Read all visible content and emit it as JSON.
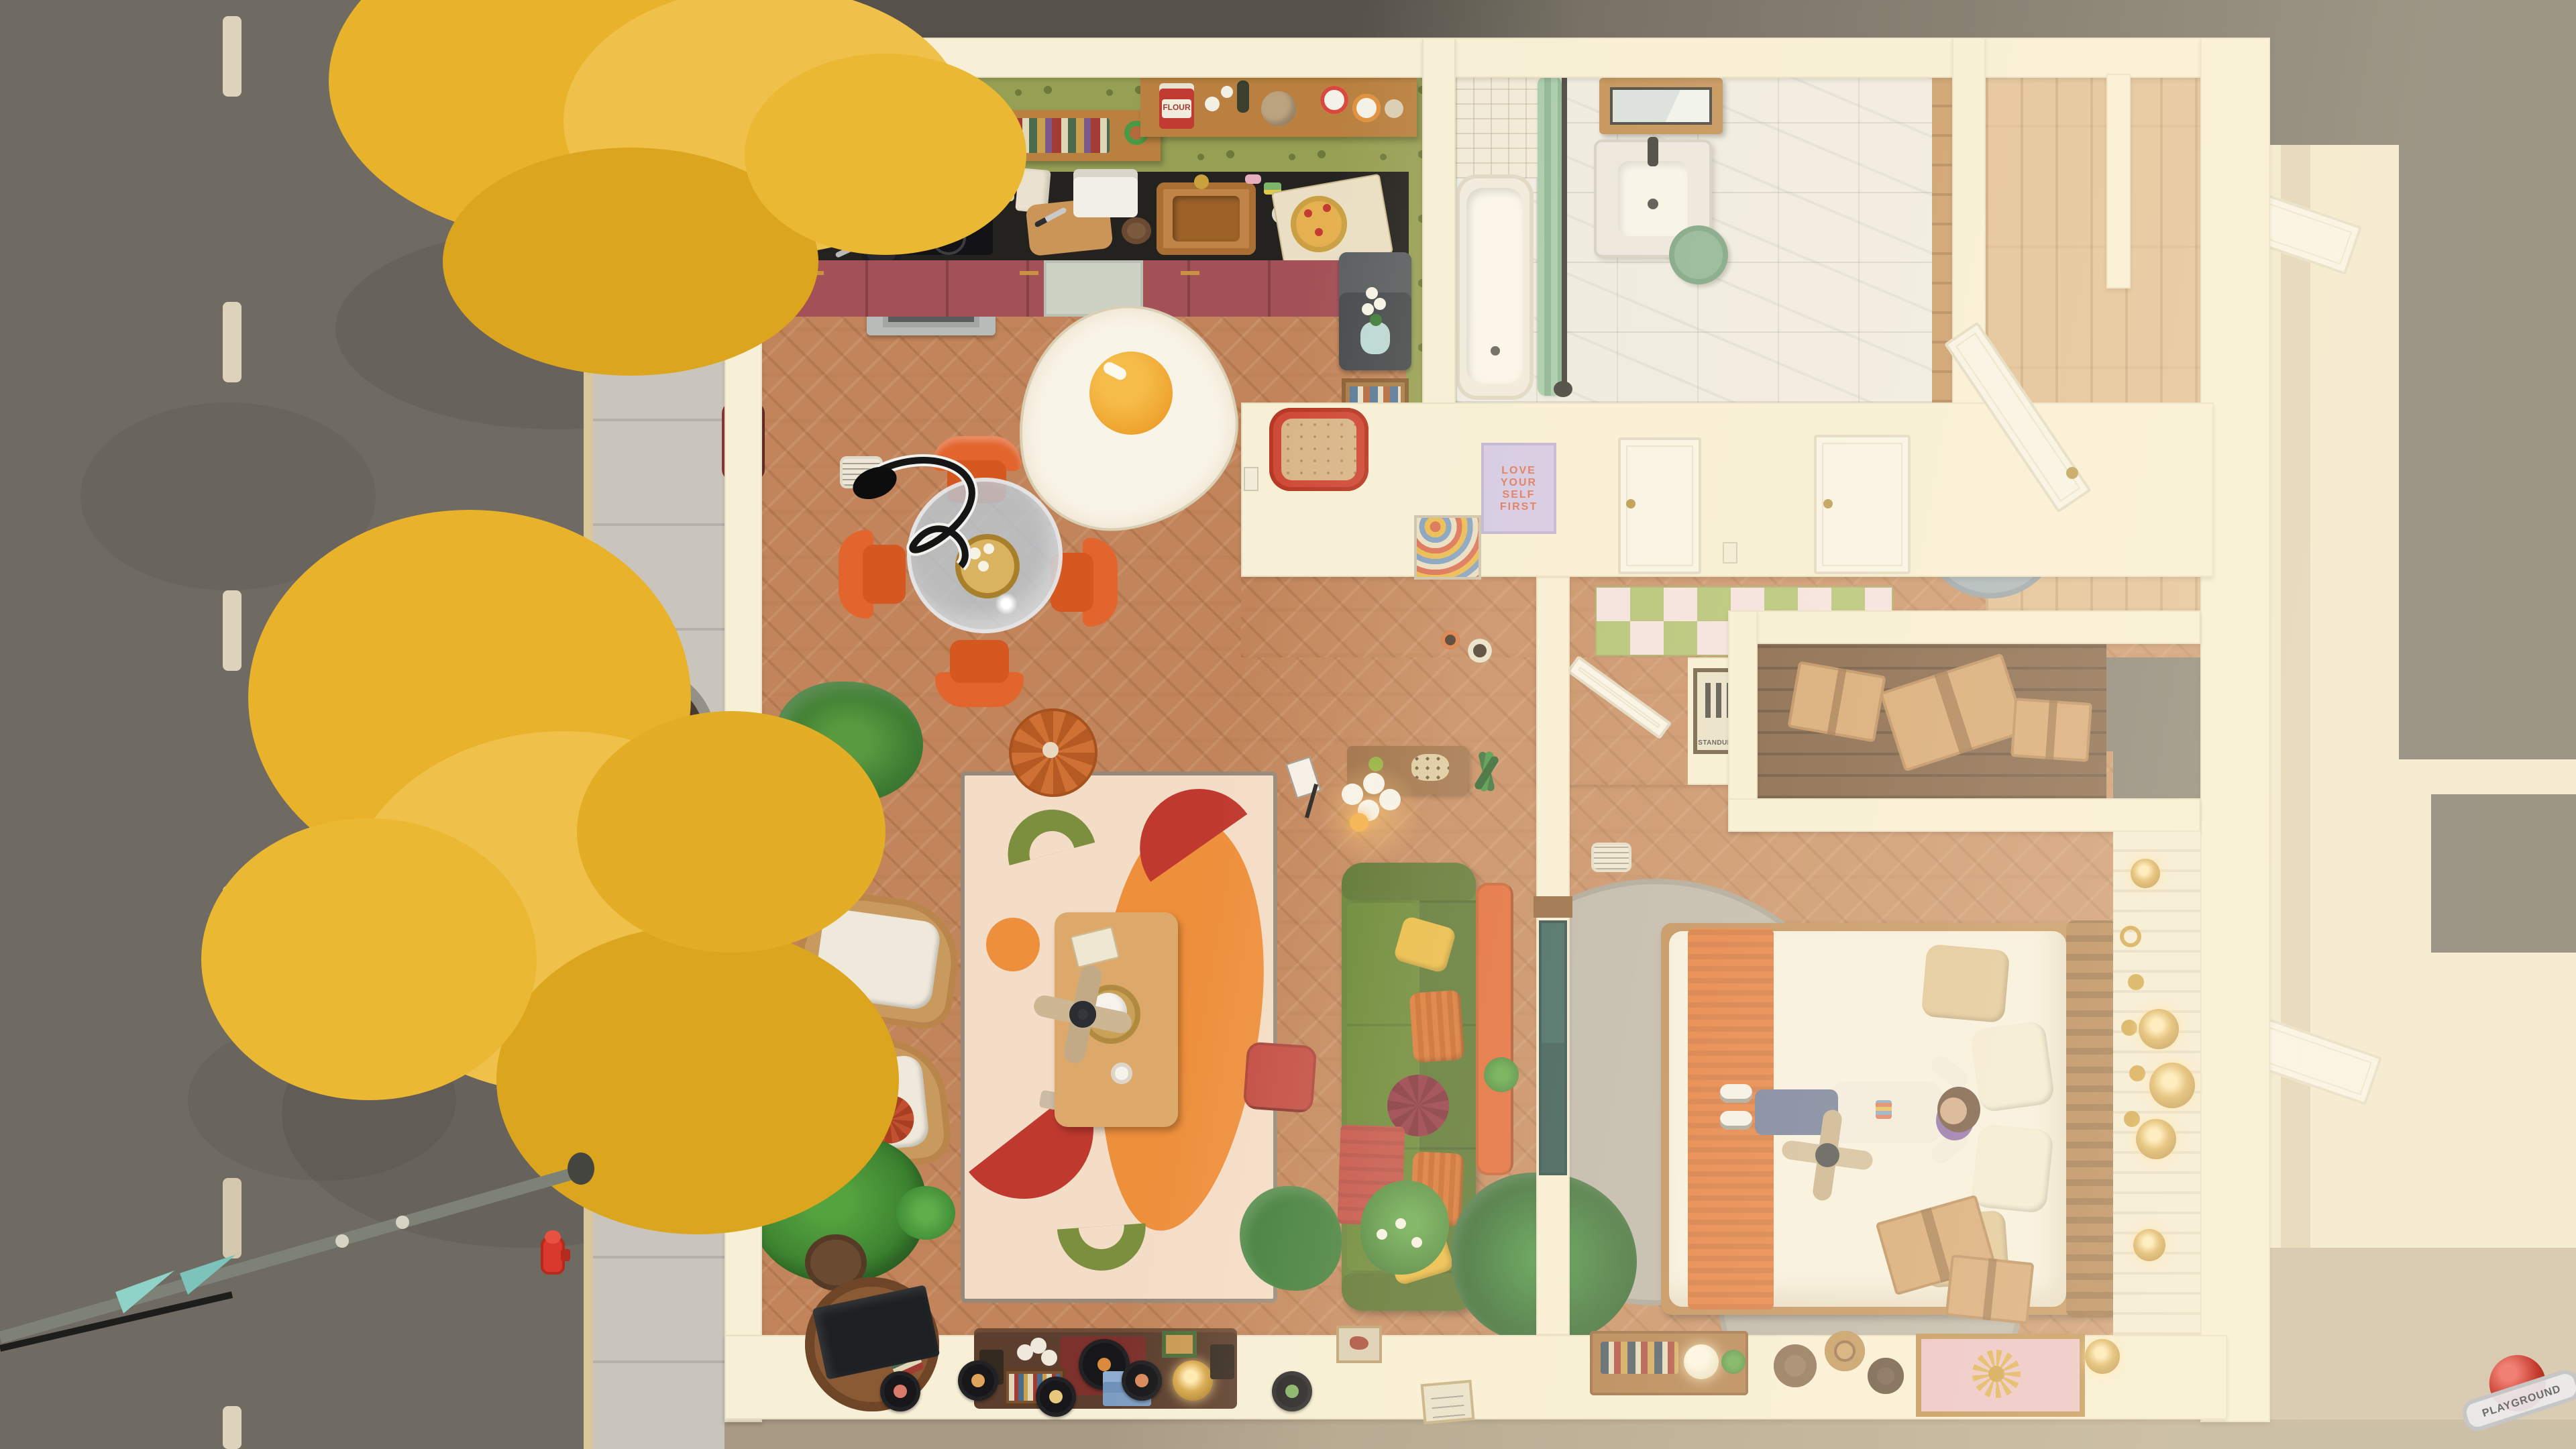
{
  "app": {
    "type": "home-design-game",
    "view": "top-down apartment floor plan with street"
  },
  "watermark": {
    "label": "PLAYGROUND"
  },
  "palette": {
    "road": "#6f6a62",
    "sidewalk": "#c9c5bc",
    "curb": "#d9c79c",
    "lane_dash": "#ddd3ba",
    "wall": "#f7f0d7",
    "floor_herringbone": "#c2855b",
    "kitchen_wallpaper": "#96a054",
    "counter": "#24221f",
    "cabinets": "#a35156",
    "sofa_green": "#5d7d30",
    "rug_cream": "#f4ddc7",
    "accent_orange": "#ec8e3d",
    "accent_red": "#c0392f",
    "olive_green": "#7c8f3e",
    "tree_yellow": "#e8b22b",
    "curtain_red": "#8c3a33",
    "bath_green": "#7fae8e",
    "divider_glass_teal": "#2c5a57",
    "gray_rug": "#b7b2a9",
    "blue_rug": "#9aabb8",
    "bed_blanket_orange": "#e2702f",
    "shelf_wood": "#b9803f",
    "watermark_red": "#c23b30"
  },
  "street": {
    "dashed_center_line": true,
    "autumn_trees": 2,
    "tree_planters": 2,
    "fire_hydrant": true,
    "street_lamp_with_flags": true
  },
  "rooms": {
    "kitchen": {
      "label": "Kitchen",
      "flour_label": "FLOUR",
      "objects": [
        "range hood",
        "induction cooktop",
        "frying pan",
        "stainless stove",
        "berry-red cabinets",
        "dishwasher",
        "black countertop",
        "wood shelves",
        "cookbooks",
        "potted herbs",
        "flour bag",
        "bottles",
        "bread loaf",
        "noodle cups",
        "coffee machine",
        "cutting board with knife",
        "copper sink",
        "sponge",
        "soap",
        "pizza box with pizza",
        "dark fridge",
        "white orchid",
        "book basket",
        "fried-egg rug",
        "floor vent"
      ]
    },
    "dining": {
      "label": "Dining nook",
      "objects": [
        "round glass table",
        "four orange velvet chairs",
        "black pendant lamp",
        "gold tray with candles"
      ]
    },
    "living": {
      "label": "Living room",
      "objects": [
        "abstract cream rug",
        "wood coffee table",
        "ceiling fan",
        "teapot",
        "teacup",
        "book",
        "orange pouf",
        "red ottoman",
        "green sofa",
        "yellow pillows",
        "orange pillows",
        "wine round pillow",
        "red blanket",
        "console table",
        "globe floor lamp",
        "music stand",
        "two rattan armchairs",
        "red round cushion",
        "palm plant",
        "banana plant",
        "monstera",
        "hanging fern with lilies",
        "snake plant",
        "media console",
        "record player",
        "vinyl record crate",
        "blue step stool",
        "woven lamp",
        "speakers",
        "leaning TV",
        "round book shelf",
        "vinyl records wall display",
        "framed prints"
      ]
    },
    "hallway": {
      "label": "Hallway",
      "objects": [
        "red wavy mirror",
        "lilac affirmation poster",
        "wavy art print",
        "two white doors",
        "green checkered runner rug",
        "light switches"
      ]
    },
    "bathroom": {
      "label": "Bathroom",
      "objects": [
        "bathtub",
        "green shower curtain",
        "black curtain rod",
        "shower head",
        "small white wall tile",
        "marble tile floor",
        "wood vanity mirror cabinet",
        "marble sink with black faucet",
        "green stool",
        "wood floor strip"
      ]
    },
    "entry": {
      "label": "Entry",
      "objects": [
        "white front door",
        "blue-gray round rug",
        "vertical plank floor",
        "niche wall"
      ]
    },
    "closet": {
      "label": "Closet",
      "objects": [
        "cardboard moving boxes",
        "dark wood floor"
      ]
    },
    "bedroom": {
      "label": "Bedroom",
      "objects": [
        "double bed",
        "wood slat headboard",
        "orange knit blanket",
        "tan and white pillows",
        "sleeping character in jeans and sneakers",
        "ceiling fan",
        "two gray round rugs",
        "teal glass divider wall",
        "orange bench",
        "yucca plant",
        "cardboard boxes",
        "white plank accent wall",
        "rattan wall lights",
        "gold woven wall discs",
        "moon phase garland",
        "three wall hats",
        "wall desk shelf with books",
        "glowing globe lamp",
        "pink and gold flower art",
        "decorative plates",
        "white door"
      ]
    }
  },
  "posters": {
    "love_yourself": {
      "lines": [
        "LOVE",
        "YOUR",
        "SELF",
        "FIRST"
      ]
    },
    "standups": {
      "label": "STANDUPS"
    }
  },
  "neighbor_building": {
    "white_doors": 2,
    "dark_rooftops": true
  }
}
